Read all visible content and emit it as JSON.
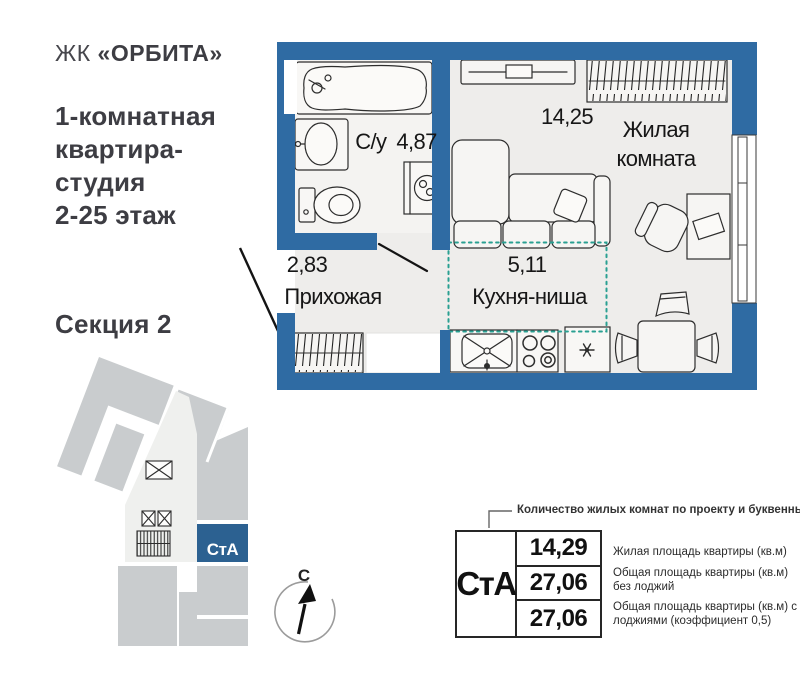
{
  "header": {
    "logo_prefix": "ЖК",
    "logo_name": "«ОРБИТА»",
    "title_lines": [
      "1-комнатная",
      "квартира-",
      "студия",
      "2-25 этаж"
    ],
    "section_label": "Секция 2"
  },
  "plan": {
    "rooms": [
      {
        "name": "С/у",
        "area": "4,87"
      },
      {
        "name": "Жилая комната",
        "area": "14,25"
      },
      {
        "name": "Прихожая",
        "area": "2,83"
      },
      {
        "name": "Кухня-ниша",
        "area": "5,11"
      }
    ]
  },
  "minimap": {
    "unit_label": "СтА"
  },
  "compass": {
    "north_label": "С"
  },
  "legend": {
    "callout": "Количество жилых комнат по проекту и буквенный код",
    "unit_code": "СтА",
    "rows": [
      {
        "value": "14,29",
        "description": "Жилая площадь квартиры (кв.м)"
      },
      {
        "value": "27,06",
        "description": "Общая площадь квартиры (кв.м) без лоджий"
      },
      {
        "value": "27,06",
        "description": "Общая площадь квартиры (кв.м) с лоджиями (коэффициент 0,5)"
      }
    ]
  },
  "colors": {
    "wall_blue": "#2f6ba3",
    "unit_highlight_blue": "#2c6191",
    "kitchen_dashed_teal": "#2aa092",
    "building_gray": "#c9ccce"
  }
}
